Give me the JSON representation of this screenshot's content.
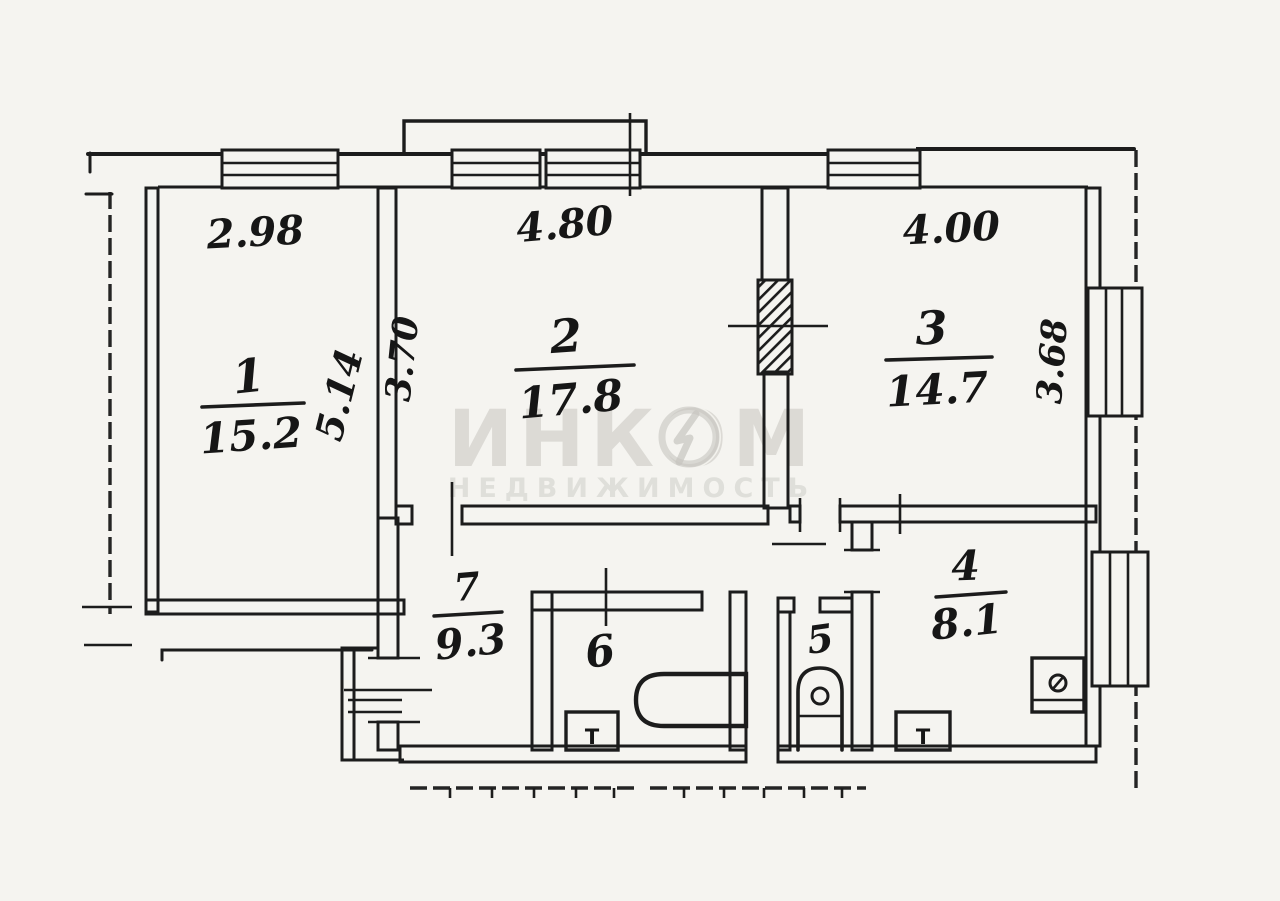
{
  "watermark": {
    "title": "ИНКОМ",
    "subtitle": "НЕДВИЖИМОСТЬ"
  },
  "rooms": [
    {
      "number": "1",
      "area": "15.2"
    },
    {
      "number": "2",
      "area": "17.8"
    },
    {
      "number": "3",
      "area": "14.7"
    },
    {
      "number": "4",
      "area": "8.1"
    },
    {
      "number": "5"
    },
    {
      "number": "6"
    },
    {
      "number": "7",
      "area": "9.3"
    }
  ],
  "dimensions": {
    "top_room1": "2.98",
    "top_room2": "4.80",
    "top_room3": "4.00",
    "side_room1": "5.14",
    "side_room2": "3.70",
    "side_room3": "3.68"
  },
  "fixtures": {
    "bath_sink": "Т",
    "kitchen_sink": "Т"
  },
  "colors": {
    "ink": "#1c1c1c",
    "paper": "#f5f4f0",
    "watermark": "#c6c5bf"
  }
}
